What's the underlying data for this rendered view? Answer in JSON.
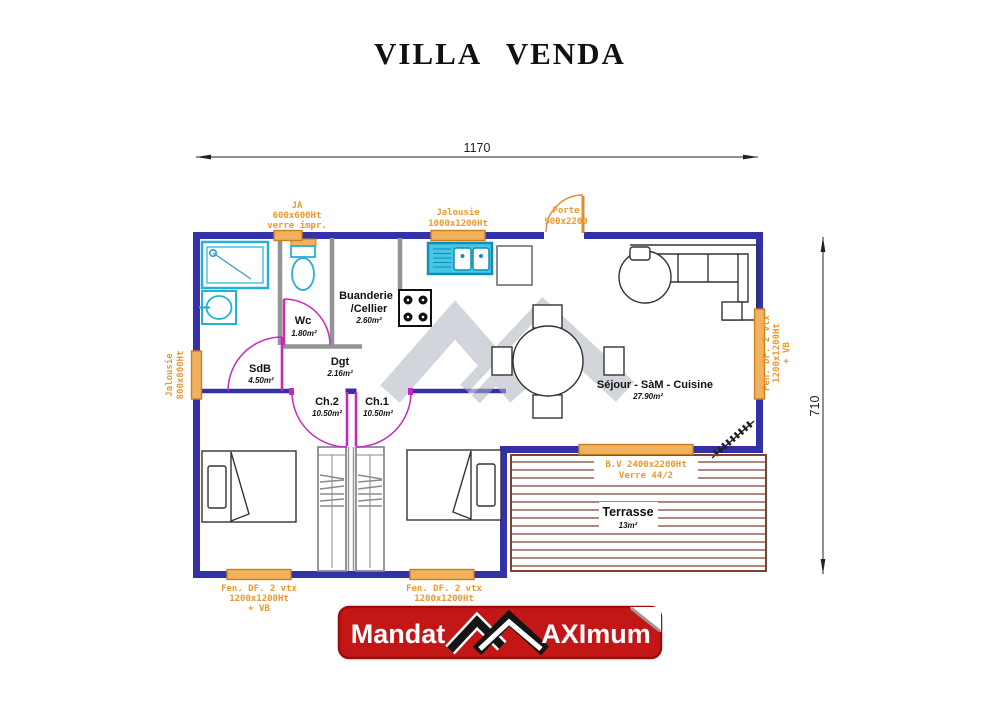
{
  "title": "VILLA VENDA",
  "dimensions": {
    "width": "1170",
    "height": "710"
  },
  "labels": {
    "ja": [
      "JA",
      "600x600Ht",
      "verre impr."
    ],
    "jalousie_top": [
      "Jalousie",
      "1000x1200Ht"
    ],
    "porte": [
      "Porte",
      "900x2200"
    ],
    "jalousie_left": [
      "Jalousie",
      "800x800Ht"
    ],
    "fen_right": [
      "Fen. DF. 2 vtx",
      "1200x1200Ht",
      "+ VB"
    ],
    "fen_bottom_left": [
      "Fen. DF. 2 vtx",
      "1200x1200Ht",
      "+ VB"
    ],
    "fen_bottom_right": [
      "Fen. DF. 2 vtx",
      "1200x1200Ht"
    ],
    "baie_vitree": [
      "B.V 2400x2200Ht",
      "Verre 44/2"
    ]
  },
  "rooms": {
    "wc": {
      "name": "Wc",
      "area": "1.80m²"
    },
    "sdb": {
      "name": "SdB",
      "area": "4.50m²"
    },
    "buanderie": {
      "name": "Buanderie",
      "name2": "/Cellier",
      "area": "2.60m²"
    },
    "dgt": {
      "name": "Dgt",
      "area": "2.16m²"
    },
    "ch2": {
      "name": "Ch.2",
      "area": "10.50m²"
    },
    "ch1": {
      "name": "Ch.1",
      "area": "10.50m²"
    },
    "sejour": {
      "name": "Séjour - SàM - Cuisine",
      "area": "27.90m²"
    },
    "terrasse": {
      "name": "Terrasse",
      "area": "13m²"
    }
  },
  "banner": {
    "left": "Mandat",
    "right": "AXImum"
  },
  "colors": {
    "outer_wall": "#3231a8",
    "interior_wall": "#949494",
    "door_swing": "#c429c4",
    "window_fill": "#f2b15e",
    "window_text": "#e9992f",
    "sanitary": "#25b0d6",
    "terrasse": "#7d4034",
    "banner_red": "#c31717",
    "watermark": "#c9ced6"
  }
}
